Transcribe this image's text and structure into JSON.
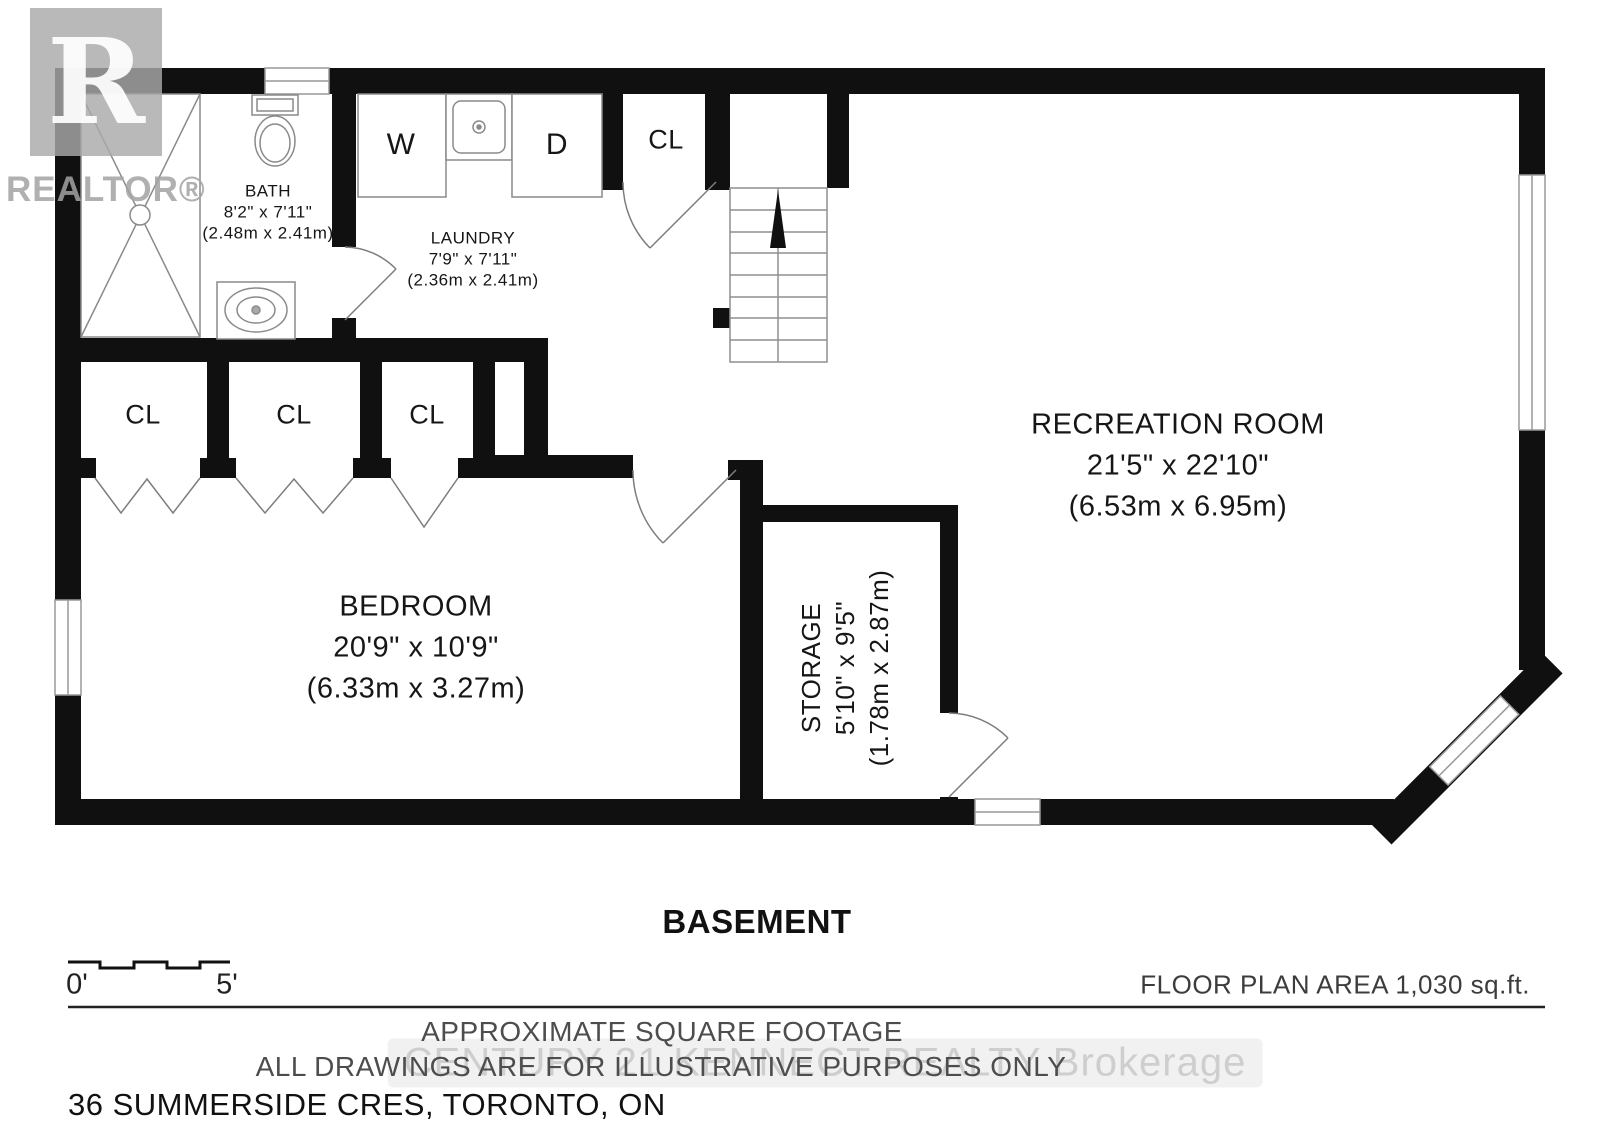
{
  "branding": {
    "realtor_logo_letter": "R",
    "realtor_logo_text": "REALTOR®",
    "brokerage_watermark": "CENTURY 21 KENNECT REALTY Brokerage"
  },
  "rooms": {
    "bath": {
      "name": "BATH",
      "imperial": "8'2\" x 7'11\"",
      "metric": "(2.48m x 2.41m)"
    },
    "laundry": {
      "name": "LAUNDRY",
      "imperial": "7'9\" x 7'11\"",
      "metric": "(2.36m x 2.41m)"
    },
    "recreation": {
      "name": "RECREATION ROOM",
      "imperial": "21'5\" x 22'10\"",
      "metric": "(6.53m x 6.95m)"
    },
    "bedroom": {
      "name": "BEDROOM",
      "imperial": "20'9\" x 10'9\"",
      "metric": "(6.33m x 3.27m)"
    },
    "storage": {
      "name": "STORAGE",
      "imperial": "5'10\" x 9'5\"",
      "metric": "(1.78m x 2.87m)"
    }
  },
  "labels": {
    "washer": "W",
    "dryer": "D",
    "closet": "CL"
  },
  "footer": {
    "floor_name": "BASEMENT",
    "scale_start": "0'",
    "scale_end": "5'",
    "area_text": "FLOOR PLAN AREA 1,030 sq.ft.",
    "disclaimer_line1": "APPROXIMATE SQUARE FOOTAGE",
    "disclaimer_line2": "ALL DRAWINGS ARE FOR ILLUSTRATIVE PURPOSES ONLY",
    "address": "36 SUMMERSIDE CRES, TORONTO, ON"
  }
}
